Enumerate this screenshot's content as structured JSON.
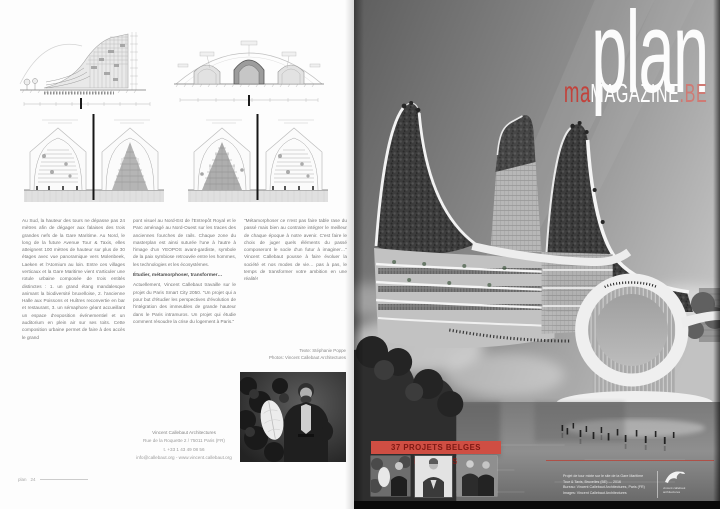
{
  "magazine": {
    "logo": {
      "word": "plan",
      "overlay": "ma",
      "suffix": "MAGAZINE",
      "tld": ".BE"
    },
    "footer_left": {
      "brand": "plan",
      "page": "24"
    }
  },
  "article": {
    "col1": "Au Sud, la hauteur des tours ne dépasse pas 24 mètres afin de dégager aux falaises des trois grandes nefs de la Gare Maritime. Au Nord, le long de la future Avenue Tour & Taxis, elles atteignent 100 mètres de hauteur sur plus de 30 étages avec vue panoramique vers Molenbeek, Laeken et l'Atomium au loin. Entre ces villages verticaux et la Gare Maritime vient s'articuler une rotule urbaine composée de trois entités distinctes : 1. un grand étang mandalesque animant la biodiversité bruxelloise, 2. l'ancienne Halle aux Poissons et Huîtres reconvertie en bar et restaurant, 3. un sémaphore géant accueillant un espace d'exposition événementiel et un auditorium en plein air sur ses toits. Cette composition urbaine permet de faire à des accès le grand",
    "col2_p1": "pont visuel au Nord-Est de l'Entrepôt Royal et le Parc aménagé au Nord-Ouest sur les traces des anciennes fourches de rails. Chaque zone du masterplan est ainsi suturée l'une à l'autre à l'image d'un YEOPOS avant-gardiste, symbole de la paix symbiose retrouvée entre les hommes, les technologies et les écosystèmes.",
    "col2_heading": "Étudier, métamorphoser, transformer…",
    "col2_p2": "Actuellement, Vincent Callebaut travaille sur le projet du Paris Smart City 2050. \"Un projet qui a pour but d'étudier les perspectives d'évolution de l'intégration des immeubles de grande hauteur dans le Paris intramuros. Un projet qui étudie comment résoudre la crise du logement à Paris.\"",
    "col3": "\"Métamorphoser ce n'est pas faire table rase du passé mais bien au contraire intégrer le meilleur de chaque époque à notre avenir. C'est faire le choix de juger quels éléments du passé composeront le socle d'un futur à imaginer…\" Vincent Callebaut pousse à faire évoluer la société et nos modes de vie… pas à pas, le temps de transformer votre ambition en une réalité!",
    "credits_line1": "Texte: Stéphanie Poppe",
    "credits_line2": "Photos: Vincent Callebaut Architectures"
  },
  "contact": {
    "name": "Vincent Callebaut Architectures",
    "address": "Rue de la Roquette 2 / 75011 Paris (FR)",
    "phone": "t. +33 1 43 49 08 56",
    "web": "info@callebaut.org - www.vincent.callebaut.org"
  },
  "right_page": {
    "banner": "37 PROJETS BELGES ÉMINENTS",
    "photo_credits": [
      "Projet de tour mixte sur le site de la Gare Maritime",
      "Tour & Taxis, Bruxelles (BE) — 2016",
      "Bureau: Vincent Callebaut Architectures, Paris (FR)",
      "Images: Vincent Callebaut Architectures"
    ],
    "logo_caption": [
      "vincent callebaut",
      "architectures"
    ]
  },
  "colors": {
    "banner_red": "#cf4e43",
    "logo_red": "#c2423b"
  }
}
